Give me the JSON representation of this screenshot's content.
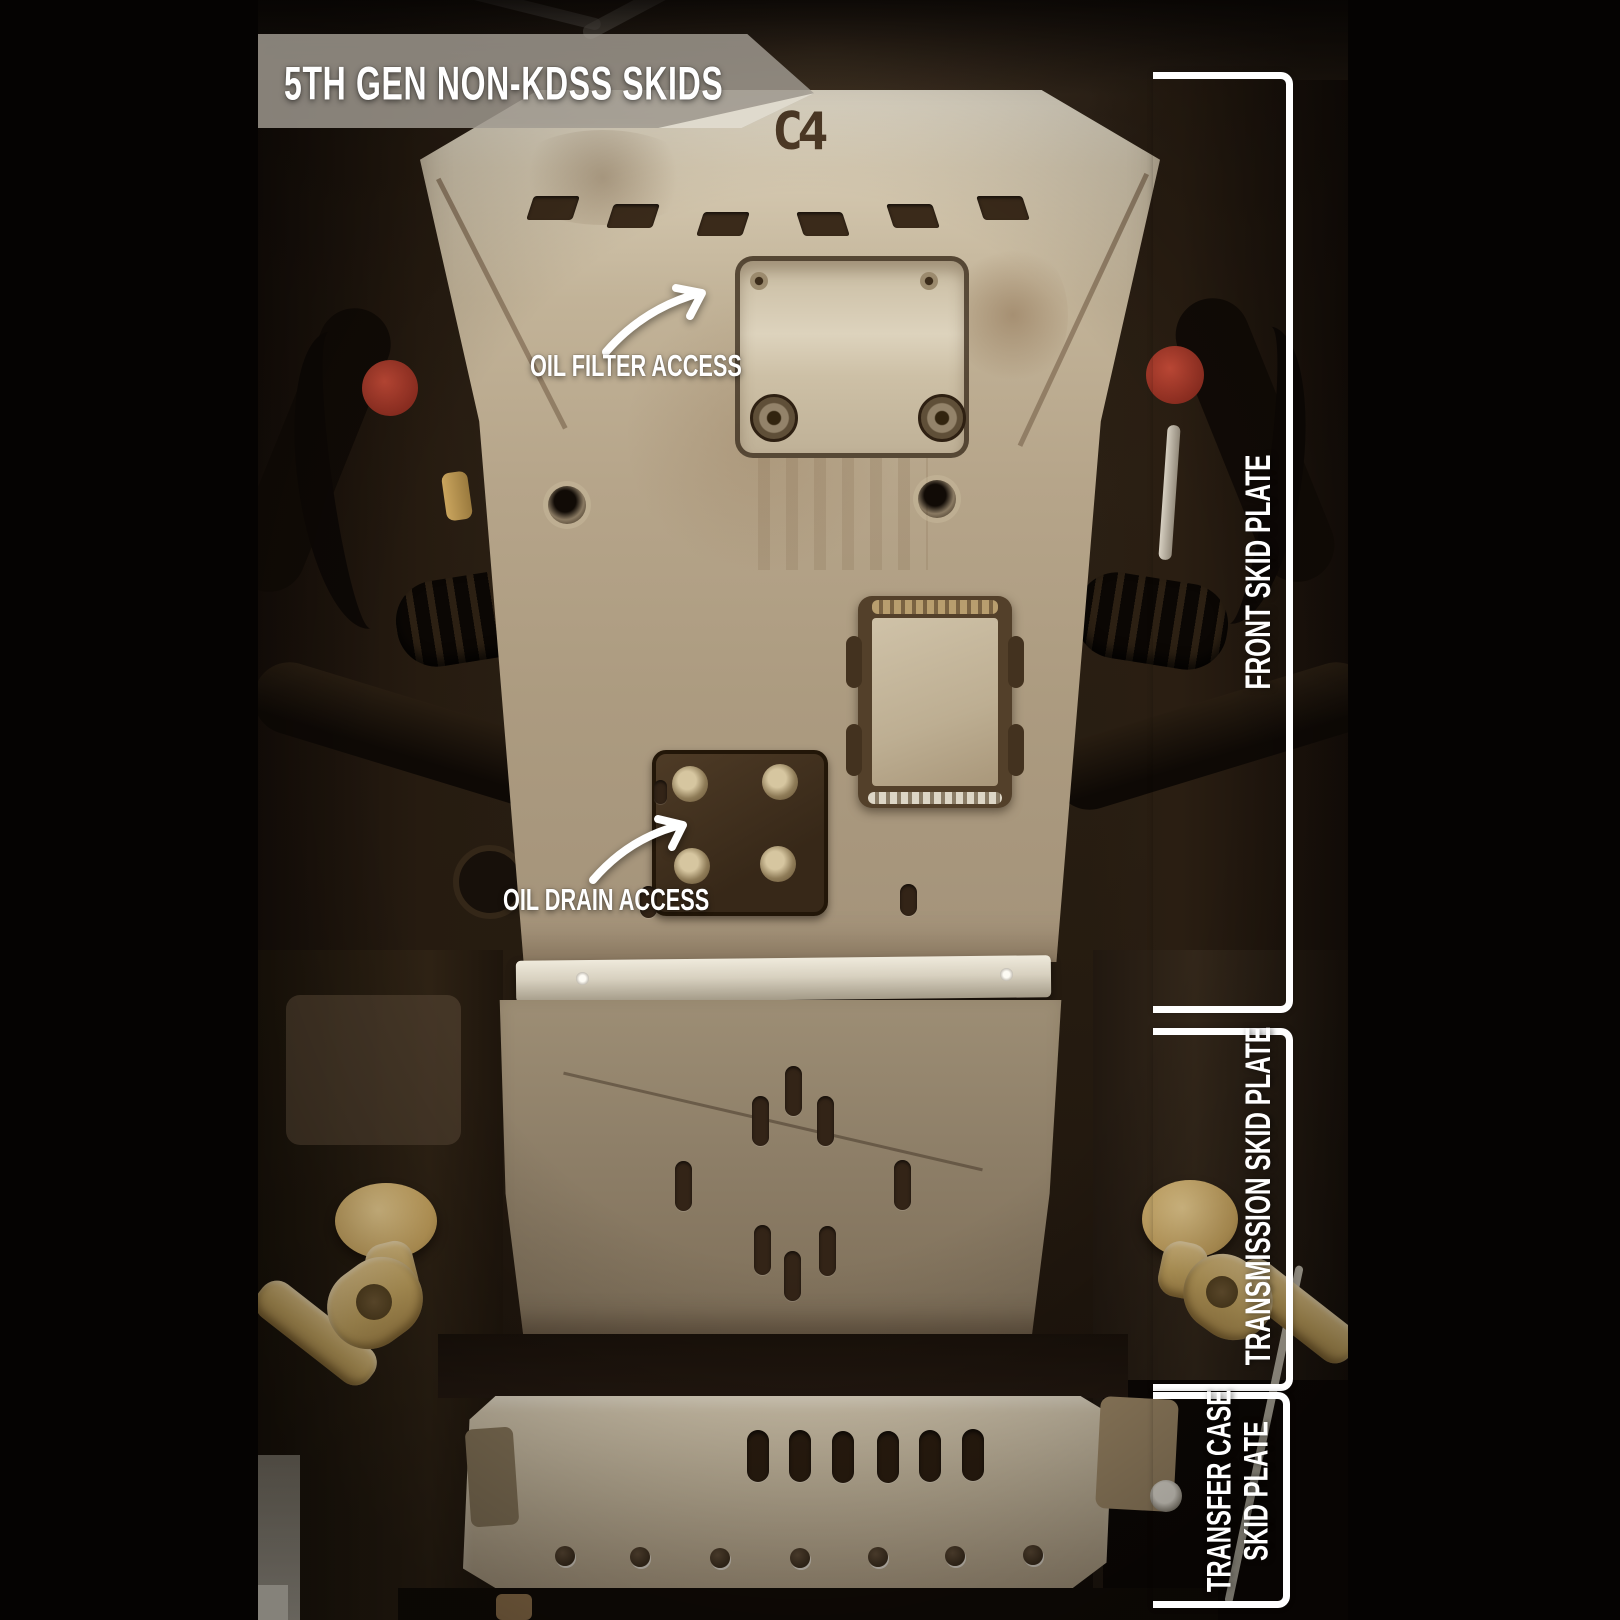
{
  "banner": {
    "title": "5TH GEN NON-KDSS SKIDS"
  },
  "logo": {
    "text": "C4"
  },
  "callouts": [
    {
      "label": "OIL FILTER ACCESS"
    },
    {
      "label": "OIL DRAIN ACCESS"
    }
  ],
  "sections": [
    {
      "label": "FRONT SKID PLATE"
    },
    {
      "label": "TRANSMISSION SKID PLATE"
    },
    {
      "line1": "TRANSFER CASE",
      "line2": "SKID PLATE"
    }
  ],
  "colors": {
    "annotation_white": "#ffffff",
    "banner_gray": "rgba(170,164,154,0.78)",
    "plate_tan": "#b5a489",
    "transmission_tan": "#8d7e67",
    "transfer_tan": "#c2b49a",
    "bushing_red": "#a83a2c",
    "link_gold": "#cfae6d",
    "background_black": "#050302"
  }
}
